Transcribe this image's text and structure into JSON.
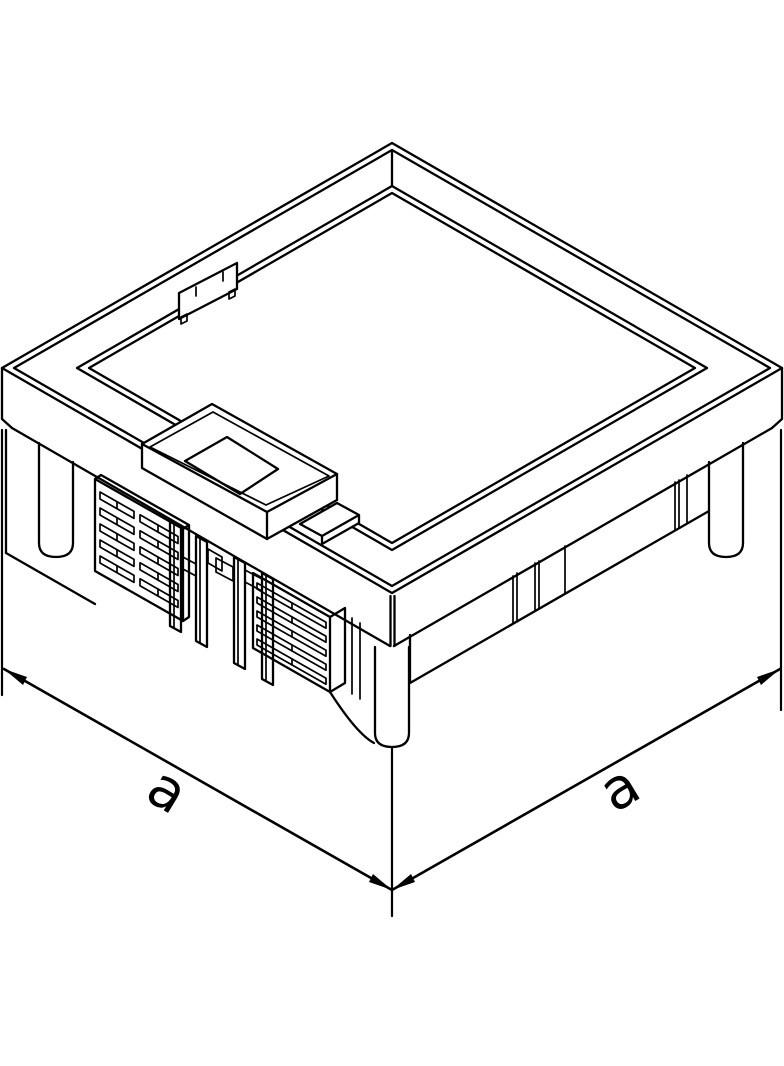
{
  "figure": {
    "kind": "isometric-technical-line-drawing",
    "subject": "square underfloor junction box with frame lid, service outlet cover, louvered inserts and corner legs",
    "background_color": "#ffffff",
    "stroke_color": "#000000"
  },
  "dimensions": {
    "left_label": "a",
    "right_label": "a"
  }
}
